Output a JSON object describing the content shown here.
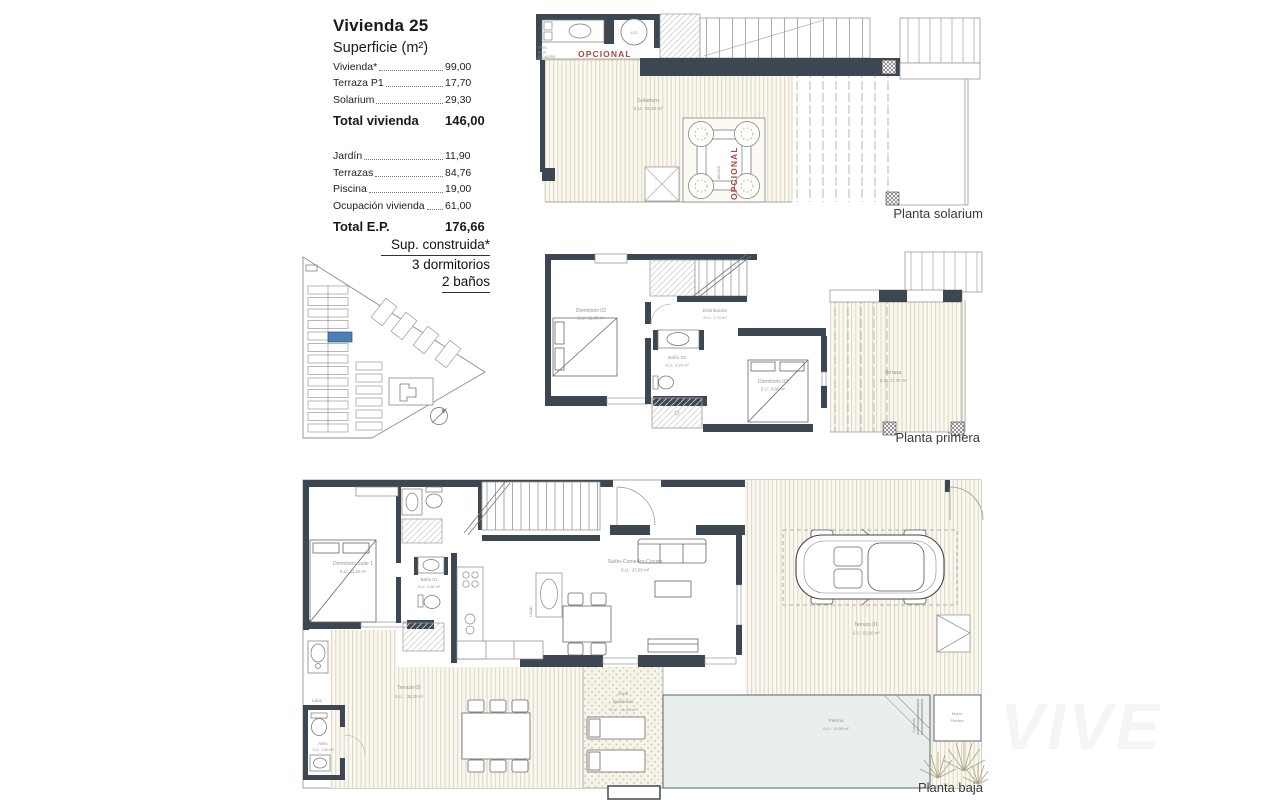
{
  "info": {
    "title": "Vivienda 25",
    "subtitle": "Superficie (m²)",
    "rows1": [
      {
        "label": "Vivienda*",
        "value": "99,00"
      },
      {
        "label": "Terraza P1",
        "value": "17,70"
      },
      {
        "label": "Solarium",
        "value": "29,30"
      }
    ],
    "total1": {
      "label": "Total vivienda",
      "value": "146,00"
    },
    "rows2": [
      {
        "label": "Jardín",
        "value": "11,90"
      },
      {
        "label": "Terrazas",
        "value": "84,76"
      },
      {
        "label": "Piscina",
        "value": "19,00"
      },
      {
        "label": "Ocupación vivienda",
        "value": "61,00"
      }
    ],
    "total2": {
      "label": "Total E.P.",
      "value": "176,66"
    }
  },
  "spec": {
    "line1": "Sup. construida*",
    "line2": "3 dormitorios",
    "line3": "2 baños"
  },
  "p1": {
    "title": "Planta solarium",
    "room": {
      "name": "Solarium",
      "area": "S.U.: 29,30 m²"
    },
    "opcional": "OPCIONAL",
    "jacuzzi_label": "JACUZZI",
    "acs": "ACS",
    "under_stairs": [
      "FREG.",
      "BAJO",
      "ESCALERA"
    ]
  },
  "p2": {
    "title": "Planta primera",
    "dorm02": {
      "name": "Dormitorio 02",
      "area": "S.U.: 11,00 m²"
    },
    "distribuidor": {
      "name": "Distribuidor",
      "area": "S.U.: 2,70 m²"
    },
    "bano02": {
      "name": "Baño 02",
      "area": "S.U.: 4,20 m²"
    },
    "dorm03": {
      "name": "Dormitorio 03",
      "area": "S.U.: 9,00 m²"
    },
    "terraza": {
      "name": "Terraza",
      "area": "S.U.: 17,70 m²"
    }
  },
  "p3": {
    "title": "Planta baja",
    "suite": {
      "name": "Dormitorio Suite 1",
      "area": "S.U.: 11,20 m²"
    },
    "bano01": {
      "name": "Baño 01",
      "area": "S.U.: 3,80 m²"
    },
    "salon": {
      "name": "Salón-Comedor-Cocina",
      "area": "S.U.: 37,00 m²"
    },
    "terraza01": {
      "name": "Terraza 01",
      "area": "S.U.: 53,66 m²"
    },
    "terraza02": {
      "name": "Terraza 02",
      "area": "S.U. : 35,30 m²"
    },
    "zona": {
      "line1": "Zona",
      "line2": "ajardinada",
      "area": "S.U. : 11,90 m²"
    },
    "piscina": {
      "name": "Piscina",
      "area": "S.U.: 19,00 m²"
    },
    "aseo": {
      "name": "Aseo",
      "area": "S.U.: 1,50 m²"
    },
    "lava": "Lava",
    "lavad": "LAVAD.",
    "cascada": "Cascada",
    "motor": {
      "line1": "Motor",
      "line2": "Piscina"
    }
  },
  "watermark": "VIVE",
  "colors": {
    "wall": "#3d4752",
    "accent_red": "#b0433d",
    "highlight_unit_blue": "#4d7fb5",
    "pool": "#e9efec",
    "deck_line": "#ddd6c2"
  }
}
